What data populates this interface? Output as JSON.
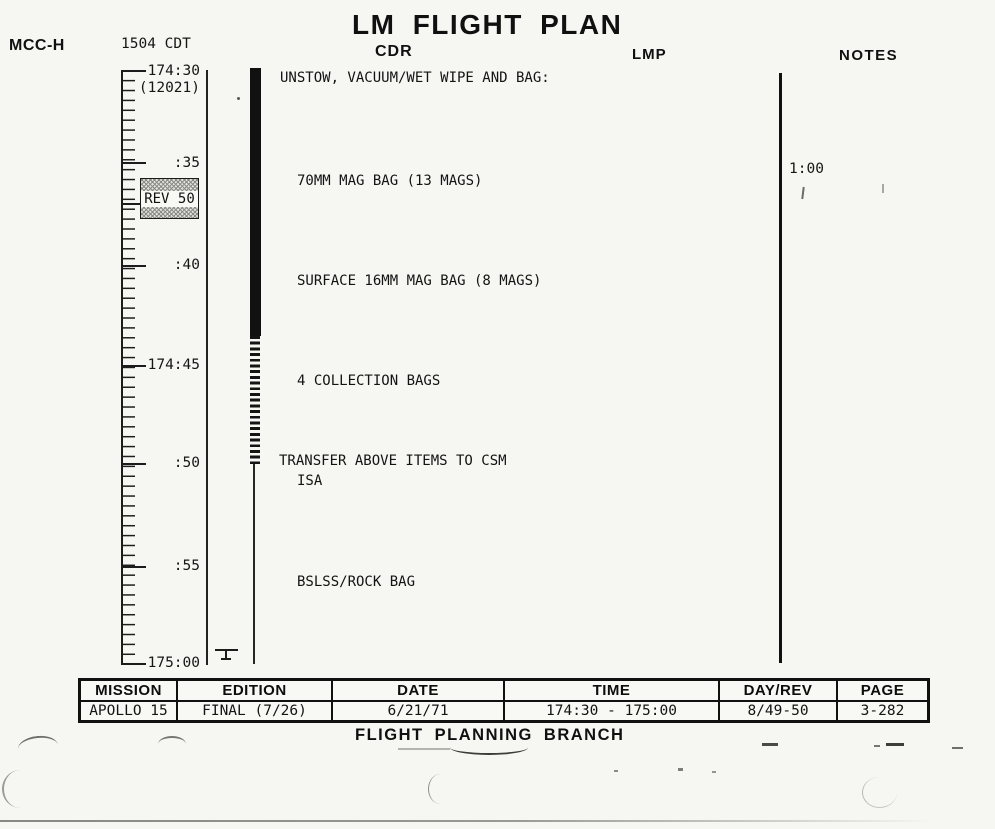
{
  "page": {
    "mcc_label": "MCC-H",
    "clock_label": "1504 CDT",
    "title": "LM FLIGHT PLAN"
  },
  "columns": {
    "cdr_header": "CDR",
    "lmp_header": "LMP",
    "notes_header": "NOTES"
  },
  "timeline": {
    "labels": [
      "174:30",
      "(12021)",
      ":35",
      ":40",
      "174:45",
      ":50",
      ":55",
      "175:00"
    ],
    "rev_marker_label": "REV 50"
  },
  "cdr": {
    "heading": "UNSTOW, VACUUM/WET WIPE AND BAG:",
    "items": [
      "70MM MAG BAG (13 MAGS)",
      "SURFACE 16MM MAG BAG (8 MAGS)",
      "4 COLLECTION BAGS",
      "ISA",
      "BSLSS/ROCK BAG"
    ],
    "transfer_note": "TRANSFER ABOVE ITEMS TO CSM"
  },
  "notes": {
    "duration_label": "1:00"
  },
  "footer_table": {
    "headers": [
      "MISSION",
      "EDITION",
      "DATE",
      "TIME",
      "DAY/REV",
      "PAGE"
    ],
    "values": [
      "APOLLO 15",
      "FINAL (7/26)",
      "6/21/71",
      "174:30 - 175:00",
      "8/49-50",
      "3-282"
    ]
  },
  "footer": {
    "branch_label": "FLIGHT PLANNING BRANCH"
  }
}
